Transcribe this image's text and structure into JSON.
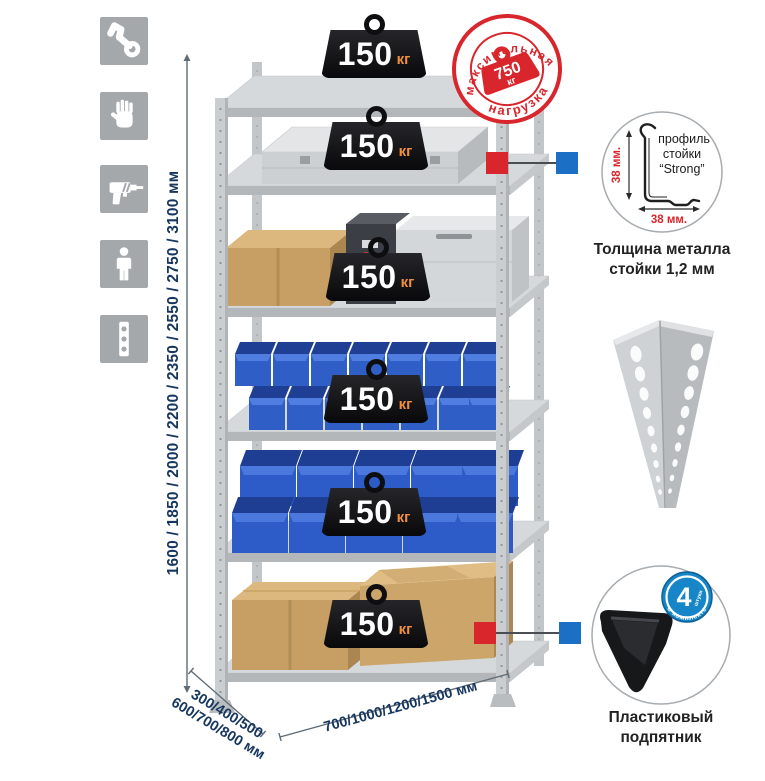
{
  "side_icons": {
    "items": [
      {
        "icon": "wrench-icon"
      },
      {
        "icon": "gloves-icon"
      },
      {
        "icon": "drill-icon"
      },
      {
        "icon": "person-icon"
      },
      {
        "icon": "level-icon"
      }
    ]
  },
  "dimensions": {
    "height_label": "1600 / 1850 / 2000 / 2200 / 2350 / 2550 / 2750 / 3100 мм",
    "depth_line1": "300/400/500",
    "depth_line2": "600/700/800 мм",
    "width_label": "700/1000/1200/1500 мм"
  },
  "rack": {
    "badges": [
      {
        "value": "150",
        "unit": "кг"
      },
      {
        "value": "150",
        "unit": "кг"
      },
      {
        "value": "150",
        "unit": "кг"
      },
      {
        "value": "150",
        "unit": "кг"
      },
      {
        "value": "150",
        "unit": "кг"
      },
      {
        "value": "150",
        "unit": "кг"
      }
    ]
  },
  "stamp": {
    "arc_top": "максимальная",
    "arc_bottom": "нагрузка",
    "value": "750",
    "unit": "кг"
  },
  "profile_detail": {
    "label_line1": "профиль",
    "label_line2": "стойки",
    "label_line3": "“Strong”",
    "dim_vertical": "38 мм.",
    "dim_horizontal": "38 мм.",
    "caption_line1": "Толщина металла",
    "caption_line2": "стойки 1,2 мм"
  },
  "foot_detail": {
    "badge_value": "4",
    "badge_note": "штуки",
    "badge_arc": "в комплекте",
    "caption_line1": "Пластиковый",
    "caption_line2": "подпятник"
  },
  "colors": {
    "accent_red": "#d8262c",
    "accent_blue": "#1b6fc4",
    "bin_blue": "#2f5ec6",
    "dim_text": "#16365f",
    "badge_unit_orange": "#ef8f3c",
    "icon_bg": "#a4a8ab",
    "metal_gray": "#c9ccce"
  }
}
